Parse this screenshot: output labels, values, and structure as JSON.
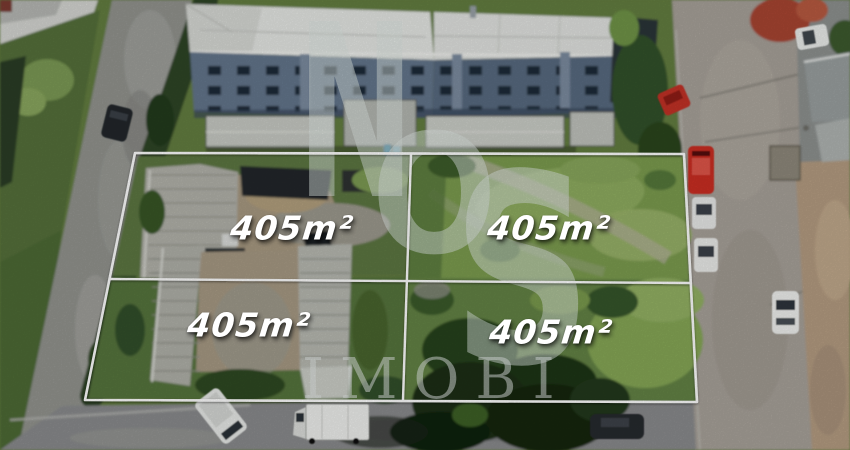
{
  "photo": {
    "description": "Aerial drone photo of four land lots outlined in white beside an apartment complex, roads and parked cars"
  },
  "lots": [
    {
      "position": "top-left",
      "area_label": "405m²"
    },
    {
      "position": "top-right",
      "area_label": "405m²"
    },
    {
      "position": "bottom-left",
      "area_label": "405m²"
    },
    {
      "position": "bottom-right",
      "area_label": "405m²"
    }
  ],
  "watermark": {
    "letter_n": "N",
    "letter_o": "O",
    "letter_s": "S",
    "wordmark": "IMOBI"
  },
  "colors": {
    "lot_outline": "#ffffff",
    "label_text": "#ffffff",
    "grass_base": "#647e40",
    "grass_bright": "#8fae5e",
    "building_facade": "#60728a",
    "building_roof": "#e6e8e5",
    "road_left": "#93948f",
    "road_right": "#a8a29a",
    "dirt": "#ac9d84",
    "red_car": "#cb2e22",
    "white_car": "#ecedeb"
  }
}
